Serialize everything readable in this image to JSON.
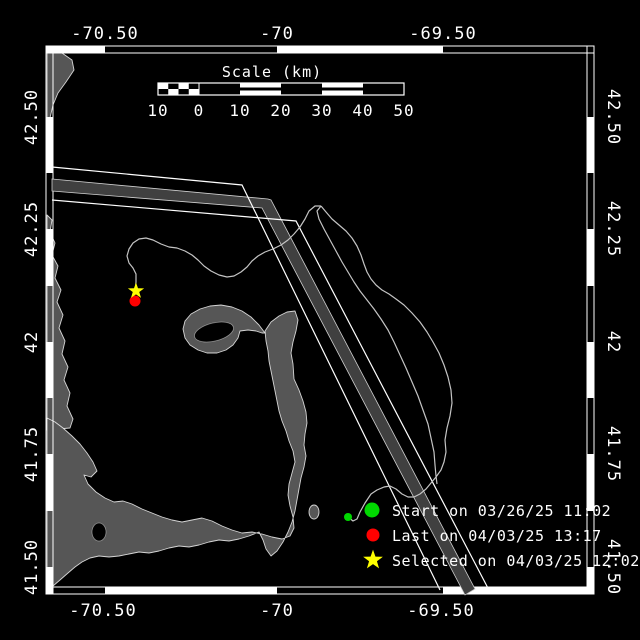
{
  "figure": {
    "background": "#000000",
    "axes": {
      "top": [
        "-70.50",
        "-70",
        "-69.50"
      ],
      "bottom": [
        "-70.50",
        "-70",
        "-69.50"
      ],
      "left": [
        "42.50",
        "42.25",
        "42",
        "41.75",
        "41.50"
      ],
      "right": [
        "42.50",
        "42.25",
        "42",
        "41.75",
        "41.50"
      ]
    },
    "scale_bar": {
      "title": "Scale (km)",
      "tick_labels": [
        "10",
        "0",
        "10",
        "20",
        "30",
        "40",
        "50"
      ]
    },
    "legend": {
      "items": [
        {
          "marker": "green-dot",
          "color": "#00d800",
          "label": "Start on 03/26/25 11:02"
        },
        {
          "marker": "red-dot",
          "color": "#ff0000",
          "label": "Last on 04/03/25 13:17"
        },
        {
          "marker": "yellow-star",
          "color": "#ffff00",
          "label": "Selected on 04/03/25 12:02"
        }
      ]
    },
    "map": {
      "land_color": "#565656",
      "separation_zone_color": "#404040",
      "track_color": "#c4c4c4",
      "frame_color": "#ffffff"
    }
  }
}
